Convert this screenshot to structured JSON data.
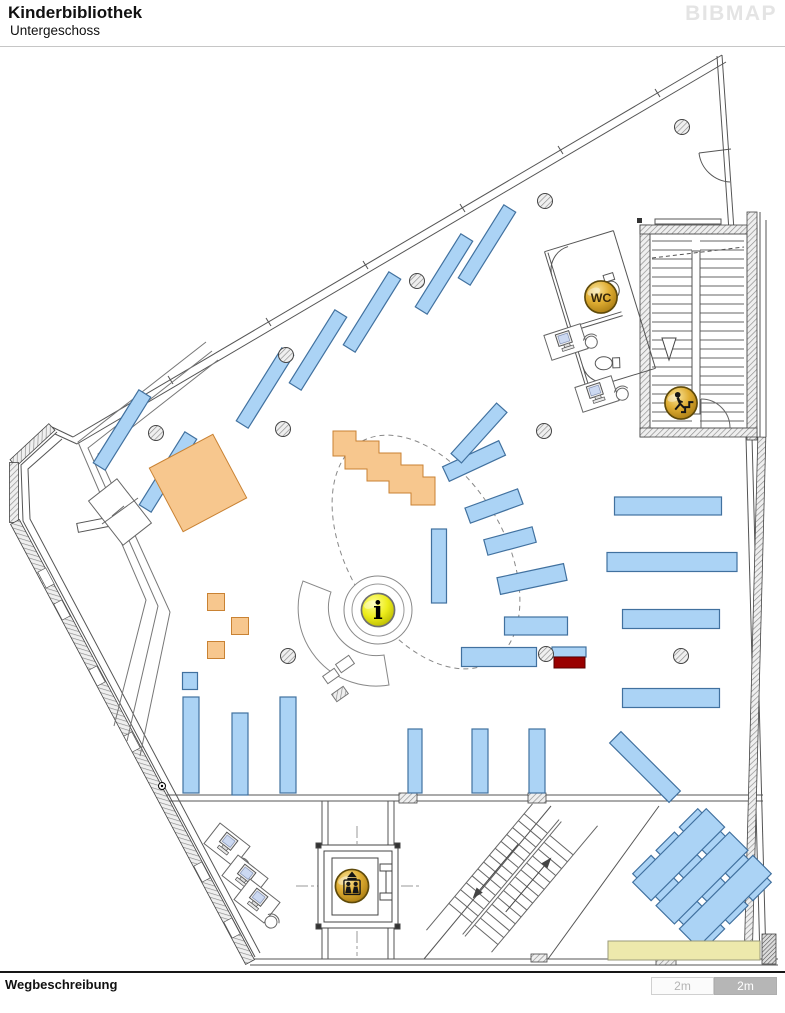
{
  "header": {
    "title": "Kinderbibliothek",
    "subtitle": "Untergeschoss",
    "logo": "BIBMAP"
  },
  "footer": {
    "label": "Wegbeschreibung"
  },
  "scalebar": {
    "segments": [
      {
        "label": "2m",
        "variant": "light"
      },
      {
        "label": "2m",
        "variant": "dark"
      }
    ]
  },
  "map": {
    "colors": {
      "shelf_fill": "#ABD3F5",
      "shelf_stroke": "#41719F",
      "orange_fill": "#F7C78E",
      "orange_stroke": "#C98233",
      "red": "#990000",
      "counter_fill": "#EDE9AC",
      "counter_stroke": "#9a9a7a",
      "wall": "#555",
      "gold_stroke": "#5f4a0a"
    },
    "icons": [
      {
        "type": "wc",
        "name": "wc-icon",
        "label": "WC",
        "x": 601,
        "y": 297,
        "r": 16.5
      },
      {
        "type": "stairs",
        "name": "stairs-up-icon",
        "label": "",
        "x": 681,
        "y": 403,
        "r": 16.5
      },
      {
        "type": "info",
        "name": "info-icon",
        "label": "i",
        "x": 378,
        "y": 610,
        "r": 17
      },
      {
        "type": "elevator",
        "name": "elevator-icon",
        "label": "",
        "x": 352,
        "y": 886,
        "r": 17
      }
    ],
    "shelves": [
      [
        122,
        430,
        14,
        86,
        32
      ],
      [
        168,
        472,
        14,
        86,
        32
      ],
      [
        265,
        388,
        14,
        86,
        32
      ],
      [
        318,
        350,
        14,
        86,
        32
      ],
      [
        372,
        312,
        14,
        86,
        32
      ],
      [
        444,
        274,
        14,
        86,
        32
      ],
      [
        487,
        245,
        14,
        86,
        32
      ],
      [
        474,
        461,
        62,
        16,
        -25
      ],
      [
        494,
        506,
        56,
        16,
        -20
      ],
      [
        510,
        541,
        50,
        16,
        -15
      ],
      [
        439,
        566,
        15,
        74,
        0
      ],
      [
        532,
        579,
        68,
        17,
        -12
      ],
      [
        536,
        626,
        63,
        18,
        0
      ],
      [
        499,
        657,
        75,
        19,
        0
      ],
      [
        569,
        652,
        34,
        10,
        0
      ],
      [
        668,
        506,
        107,
        18,
        0
      ],
      [
        672,
        562,
        130,
        19,
        0
      ],
      [
        671,
        619,
        97,
        19,
        0
      ],
      [
        671,
        698,
        97,
        19,
        0
      ],
      [
        190,
        681,
        15,
        17,
        0
      ],
      [
        191,
        745,
        16,
        96,
        0
      ],
      [
        240,
        754,
        16,
        82,
        0
      ],
      [
        288,
        745,
        16,
        96,
        0
      ],
      [
        415,
        761,
        14,
        64,
        0
      ],
      [
        480,
        761,
        16,
        64,
        0
      ],
      [
        537,
        761,
        16,
        64,
        0
      ],
      [
        479,
        433,
        14,
        68,
        42
      ],
      [
        645,
        767,
        16,
        84,
        -45
      ]
    ],
    "crisscross": {
      "cx": 702,
      "cy": 878,
      "len": 104,
      "thick": 26,
      "gap": 33
    },
    "orange_rects": [
      [
        198,
        483,
        72,
        72,
        -28
      ],
      [
        216,
        602,
        17,
        17,
        0
      ],
      [
        240,
        626,
        17,
        17,
        0
      ],
      [
        216,
        650,
        17,
        17,
        0
      ]
    ],
    "orange_steps_points": "333,456 333,431 356,431 356,441 379,441 379,453 401,453 401,465 423,465 423,477 435,477 435,505 411,505 411,493 389,493 389,481 367,481 367,469 345,469 345,456",
    "red_rect": [
      554,
      657,
      31,
      11
    ],
    "counter_rect": [
      608,
      941,
      152,
      19
    ],
    "columns": [
      [
        156,
        433
      ],
      [
        286,
        355
      ],
      [
        417,
        281
      ],
      [
        545,
        201
      ],
      [
        283,
        429
      ],
      [
        544,
        431
      ],
      [
        682,
        127
      ],
      [
        288,
        656
      ],
      [
        681,
        656
      ],
      [
        546,
        654
      ]
    ],
    "computer_stations": [
      [
        227,
        845,
        38
      ],
      [
        245,
        877,
        38
      ],
      [
        257,
        901,
        38
      ],
      [
        566,
        342,
        -18
      ],
      [
        597,
        394,
        -18
      ]
    ],
    "stairwell": {
      "x1": 652,
      "x2": 744,
      "y1": 241,
      "y2": 424,
      "step": 9,
      "sx1": 692,
      "sx2": 700
    },
    "diag_stairs": {
      "cx": 512,
      "cy": 878,
      "rot": -50,
      "half": 60,
      "band": 32,
      "step": 9
    }
  }
}
